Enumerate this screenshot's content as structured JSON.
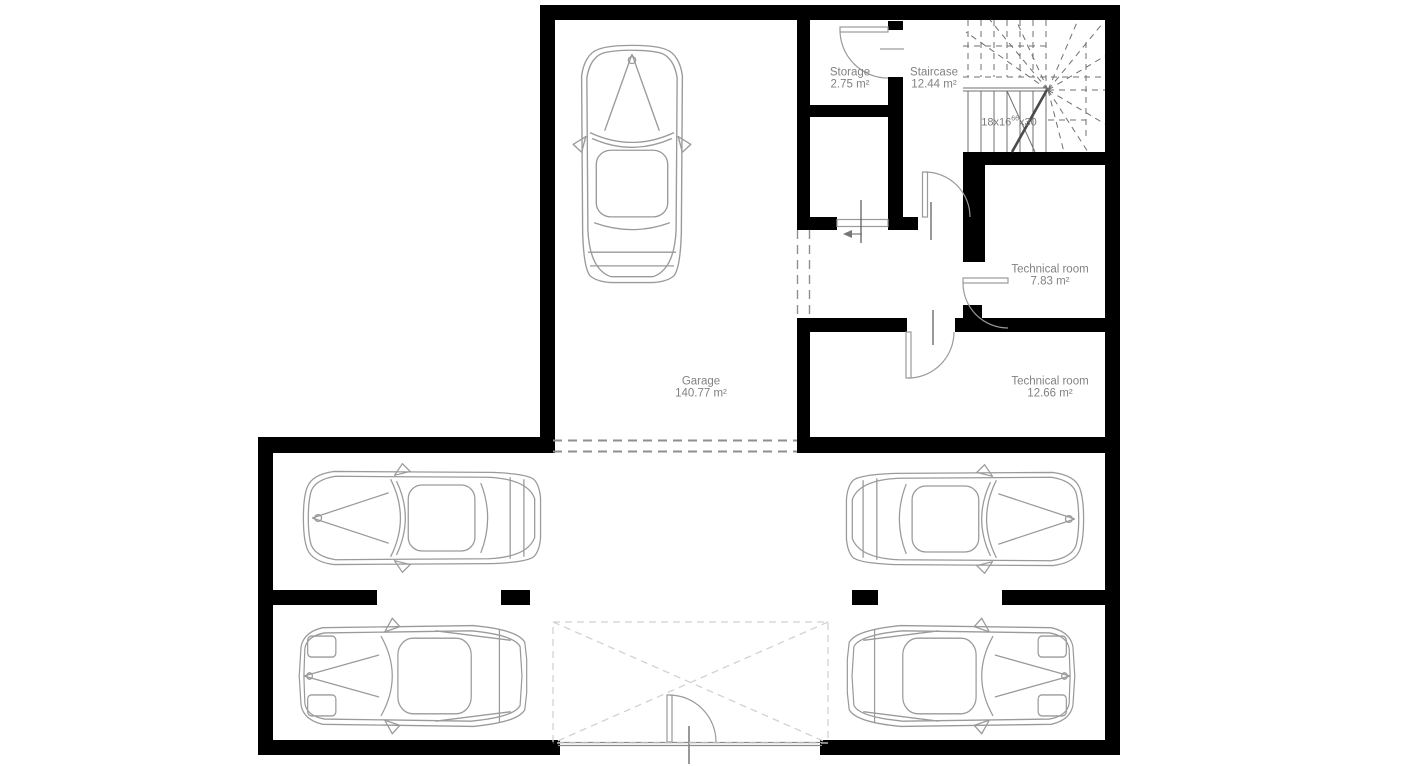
{
  "rooms": {
    "garage": {
      "name": "Garage",
      "area": "140.77 m²"
    },
    "storage": {
      "name": "Storage",
      "area": "2.75 m²"
    },
    "staircase": {
      "name": "Staircase",
      "area": "12.44 m²"
    },
    "technical_small": {
      "name": "Technical room",
      "area": "7.83 m²"
    },
    "technical_large": {
      "name": "Technical room",
      "area": "12.66 m²"
    }
  },
  "stair": {
    "prefix": "18x16",
    "sup": "66",
    "suffix": "x30"
  },
  "colors": {
    "wall": "#000000",
    "thin_line": "#9a9a9a",
    "label_text": "#828282",
    "dashed_line": "#8f8f8f",
    "door_zone": "#d2d2d2",
    "stair_line": "#6f6f6f"
  }
}
